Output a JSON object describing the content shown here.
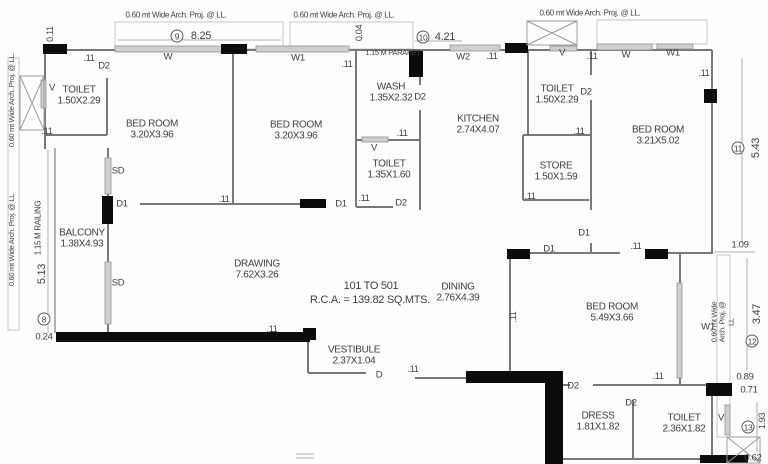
{
  "colors": {
    "background": "#ffffff",
    "wall": "#787878",
    "column": "#0c0c0c",
    "window_fill": "#cfcfcf",
    "light_line": "#c2c2c2",
    "text": "#3e3e3e"
  },
  "plan": {
    "labels": {
      "rooms": [
        {
          "n": "toilet-tl-label",
          "t": "TOILET\n1.50X2.29",
          "x": 79,
          "y": 96
        },
        {
          "n": "bedroom-1-label",
          "t": "BED ROOM\n3.20X3.96",
          "x": 152,
          "y": 130
        },
        {
          "n": "bedroom-2-label",
          "t": "BED ROOM\n3.20X3.96",
          "x": 296,
          "y": 131
        },
        {
          "n": "wash-label",
          "t": "WASH\n1.35X2.32",
          "x": 391,
          "y": 93
        },
        {
          "n": "kitchen-label",
          "t": "KITCHEN\n2.74X4.07",
          "x": 478,
          "y": 125
        },
        {
          "n": "toilet-mid-label",
          "t": "TOILET\n1.35X1.60",
          "x": 389,
          "y": 170
        },
        {
          "n": "toilet-tr-label",
          "t": "TOILET\n1.50X2.29",
          "x": 557,
          "y": 95
        },
        {
          "n": "store-label",
          "t": "STORE\n1.50X1.59",
          "x": 556,
          "y": 172
        },
        {
          "n": "bedroom-3-label",
          "t": "BED ROOM\n3.21X5.02",
          "x": 658,
          "y": 136
        },
        {
          "n": "balcony-label",
          "t": "BALCONY\n1.38X4.93",
          "x": 82,
          "y": 239
        },
        {
          "n": "drawing-label",
          "t": "DRAWING\n7.62X3.26",
          "x": 257,
          "y": 270
        },
        {
          "n": "dining-label",
          "t": "DINING\n2.76X4.39",
          "x": 458,
          "y": 293
        },
        {
          "n": "vestibule-label",
          "t": "VESTIBULE\n2.37X1.04",
          "x": 354,
          "y": 356
        },
        {
          "n": "bedroom-4-label",
          "t": "BED ROOM\n5.49X3.66",
          "x": 612,
          "y": 313
        },
        {
          "n": "dress-label",
          "t": "DRESS\n1.81X1.82",
          "x": 598,
          "y": 422
        },
        {
          "n": "toilet-br-label",
          "t": "TOILET\n2.36X1.82",
          "x": 684,
          "y": 424
        }
      ],
      "openings": [
        {
          "n": "window-w-bed1",
          "t": "W",
          "x": 168,
          "y": 58,
          "s": 9.5
        },
        {
          "n": "window-w1-bed2",
          "t": "W1",
          "x": 298,
          "y": 59,
          "s": 9.5
        },
        {
          "n": "door-d2-toilet-tl",
          "t": "D2",
          "x": 104,
          "y": 67,
          "s": 9.5
        },
        {
          "n": "vent-toilet-tl",
          "t": "V",
          "x": 52,
          "y": 89,
          "s": 9.5
        },
        {
          "n": "slider-sd-upper",
          "t": "SD",
          "x": 118,
          "y": 172,
          "s": 9.5
        },
        {
          "n": "slider-sd-lower",
          "t": "SD",
          "x": 118,
          "y": 284,
          "s": 9.5
        },
        {
          "n": "door-d1-balcony",
          "t": "D1",
          "x": 122,
          "y": 205,
          "s": 9.5
        },
        {
          "n": "door-d1-bed1",
          "t": "D1",
          "x": 341,
          "y": 205,
          "s": 9.5
        },
        {
          "n": "door-d2-wash",
          "t": "D2",
          "x": 420,
          "y": 98,
          "s": 9.5
        },
        {
          "n": "vent-toilet-mid",
          "t": "V",
          "x": 374,
          "y": 149,
          "s": 9.5
        },
        {
          "n": "door-d2-toilet-mid",
          "t": "D2",
          "x": 401,
          "y": 204,
          "s": 9.5
        },
        {
          "n": "window-w2-kitchen",
          "t": "W2",
          "x": 463,
          "y": 58,
          "s": 9.5
        },
        {
          "n": "vent-shaft-top",
          "t": "V",
          "x": 562,
          "y": 54,
          "s": 9.5
        },
        {
          "n": "door-d2-toilet-tr",
          "t": "D2",
          "x": 586,
          "y": 93,
          "s": 9.5
        },
        {
          "n": "window-w-bed3",
          "t": "W",
          "x": 626,
          "y": 56,
          "s": 9.5
        },
        {
          "n": "window-w1-bed3",
          "t": "W1",
          "x": 673,
          "y": 54,
          "s": 9.5
        },
        {
          "n": "door-d1-bed3",
          "t": "D1",
          "x": 584,
          "y": 234,
          "s": 9.5
        },
        {
          "n": "door-d1-bed4",
          "t": "D1",
          "x": 549,
          "y": 250,
          "s": 9.5
        },
        {
          "n": "window-w1-bed4",
          "t": "W1",
          "x": 708,
          "y": 328,
          "s": 9.5
        },
        {
          "n": "door-d-entry",
          "t": "D",
          "x": 379,
          "y": 376,
          "s": 9.5
        },
        {
          "n": "door-d2-dress",
          "t": "D2",
          "x": 573,
          "y": 387,
          "s": 9.5
        },
        {
          "n": "door-d2-toilet-br",
          "t": "D2",
          "x": 631,
          "y": 404,
          "s": 9.5
        },
        {
          "n": "vent-toilet-br",
          "t": "V",
          "x": 721,
          "y": 419,
          "s": 9.5
        }
      ],
      "dimensions": [
        {
          "t": ".11",
          "x": 89,
          "y": 58,
          "s": 9
        },
        {
          "t": ".11",
          "x": 47,
          "y": 131,
          "s": 9
        },
        {
          "t": ".11",
          "x": 347,
          "y": 64,
          "s": 9
        },
        {
          "t": ".11",
          "x": 402,
          "y": 133,
          "s": 9
        },
        {
          "t": ".11",
          "x": 492,
          "y": 56,
          "s": 9
        },
        {
          "t": ".11",
          "x": 592,
          "y": 56,
          "s": 9
        },
        {
          "t": ".11",
          "x": 704,
          "y": 73,
          "s": 9
        },
        {
          "t": ".11",
          "x": 579,
          "y": 131,
          "s": 9
        },
        {
          "t": ".11",
          "x": 530,
          "y": 196,
          "s": 9
        },
        {
          "t": ".11",
          "x": 364,
          "y": 198,
          "s": 9
        },
        {
          "t": ".11",
          "x": 224,
          "y": 199,
          "s": 9
        },
        {
          "t": ".11",
          "x": 272,
          "y": 329,
          "s": 9
        },
        {
          "t": ".11",
          "x": 413,
          "y": 369,
          "s": 9
        },
        {
          "t": ".11",
          "x": 636,
          "y": 246,
          "s": 9
        },
        {
          "t": ".11",
          "x": 513,
          "y": 317,
          "r": -90,
          "s": 9
        },
        {
          "t": ".11",
          "x": 658,
          "y": 376,
          "s": 9
        },
        {
          "t": "0.11",
          "x": 50,
          "y": 34,
          "r": -90,
          "s": 9
        },
        {
          "t": "0.04",
          "x": 359,
          "y": 33,
          "r": -90,
          "s": 9
        },
        {
          "t": "8.25",
          "x": 201,
          "y": 36,
          "s": 11
        },
        {
          "t": "4.21",
          "x": 445,
          "y": 37,
          "s": 11
        },
        {
          "t": "5.43",
          "x": 756,
          "y": 148,
          "r": -90,
          "s": 11
        },
        {
          "t": "5.13",
          "x": 42,
          "y": 274,
          "r": -90,
          "s": 11
        },
        {
          "t": "0.24",
          "x": 44,
          "y": 338,
          "s": 9.5
        },
        {
          "t": "1.09",
          "x": 740,
          "y": 246,
          "s": 9.5
        },
        {
          "t": "3.47",
          "x": 757,
          "y": 314,
          "r": -90,
          "s": 11
        },
        {
          "t": "0.89",
          "x": 745,
          "y": 378,
          "s": 9.5
        },
        {
          "t": "0.71",
          "x": 749,
          "y": 391,
          "s": 9.5
        },
        {
          "t": "1.93",
          "x": 762,
          "y": 421,
          "r": -90,
          "s": 9
        },
        {
          "t": "0.62",
          "x": 753,
          "y": 459,
          "s": 9.5
        }
      ],
      "annotations": [
        {
          "n": "flats-range-label",
          "t": "101 TO 501",
          "x": 371,
          "y": 286,
          "s": 11
        },
        {
          "n": "rca-area-label",
          "t": "R.C.A. = 139.82 SQ.MTS.",
          "x": 370,
          "y": 300,
          "s": 11
        },
        {
          "n": "arch-proj-top-left",
          "t": "0.60 mt Wide Arch. Proj. @ LL.",
          "x": 176,
          "y": 15,
          "s": 8
        },
        {
          "n": "arch-proj-top-mid",
          "t": "0.60 mt Wide Arch. Proj. @ LL.",
          "x": 344,
          "y": 15,
          "s": 8
        },
        {
          "n": "arch-proj-top-right",
          "t": "0.60 mt Wide Arch. Proj. @ LL.",
          "x": 590,
          "y": 13,
          "s": 8
        },
        {
          "n": "arch-proj-left-upper",
          "t": "0.60 mt Wide Arch. Proj. @ LL.",
          "x": 12,
          "y": 100,
          "r": -90,
          "s": 7.5
        },
        {
          "n": "arch-proj-left-lower",
          "t": "0.60 mt Wide Arch. Proj. @ LL",
          "x": 12,
          "y": 240,
          "r": -90,
          "s": 7.5
        },
        {
          "n": "arch-proj-right",
          "t": "0.60 mt Wide Arch. Proj. @ LL",
          "x": 723,
          "y": 322,
          "r": -90,
          "s": 7.5
        },
        {
          "n": "parapet-label",
          "t": "1.15 M PARAPET",
          "x": 393,
          "y": 53,
          "s": 7.5
        },
        {
          "n": "railing-label",
          "t": "1.15 M RAILING",
          "x": 38,
          "y": 228,
          "r": -90,
          "s": 8
        }
      ],
      "grid_bubbles": [
        {
          "n": "grid-9",
          "t": "9",
          "x": 177,
          "y": 36,
          "c": true
        },
        {
          "n": "grid-10",
          "t": "10",
          "x": 423,
          "y": 37,
          "c": true
        },
        {
          "n": "grid-11",
          "t": "11",
          "x": 738,
          "y": 148,
          "c": true
        },
        {
          "n": "grid-8",
          "t": "8",
          "x": 44,
          "y": 319,
          "c": true
        },
        {
          "n": "grid-12",
          "t": "12",
          "x": 752,
          "y": 341,
          "c": true
        },
        {
          "n": "grid-13",
          "t": "13",
          "x": 748,
          "y": 427,
          "c": true
        }
      ]
    }
  }
}
